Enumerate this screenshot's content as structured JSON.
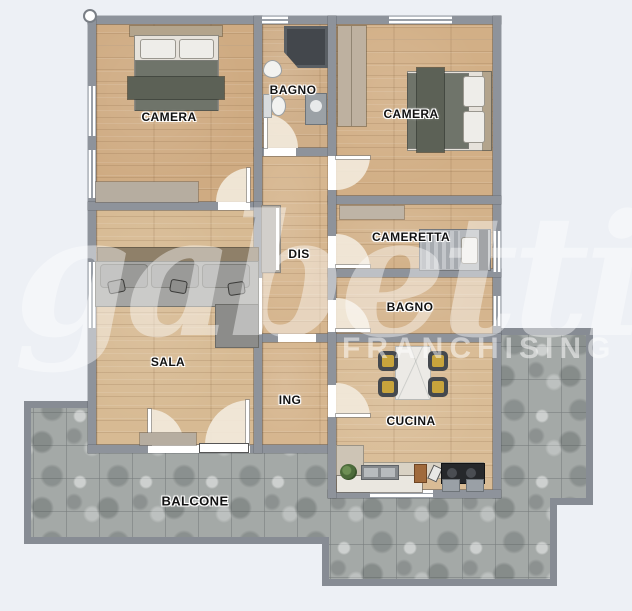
{
  "rooms": {
    "camera1": {
      "label": "CAMERA"
    },
    "bagno1": {
      "label": "BAGNO"
    },
    "camera2": {
      "label": "CAMERA"
    },
    "dis": {
      "label": "DIS"
    },
    "cameretta": {
      "label": "CAMERETTA"
    },
    "bagno2": {
      "label": "BAGNO"
    },
    "sala": {
      "label": "SALA"
    },
    "ing": {
      "label": "ING"
    },
    "cucina": {
      "label": "CUCINA"
    },
    "balcone": {
      "label": "BALCONE"
    }
  },
  "watermark": {
    "script": "gabetti",
    "subtext": "FRANCHISING"
  },
  "colors": {
    "background": "#EDF0F5",
    "wall": "#8E939B",
    "wood_floor": "#D2B088",
    "balcony_tile": "#A4A9A7",
    "blanket": "#6F746A",
    "chair_cushion": "#C8A43C",
    "door_arc": "#F2E9DB"
  }
}
